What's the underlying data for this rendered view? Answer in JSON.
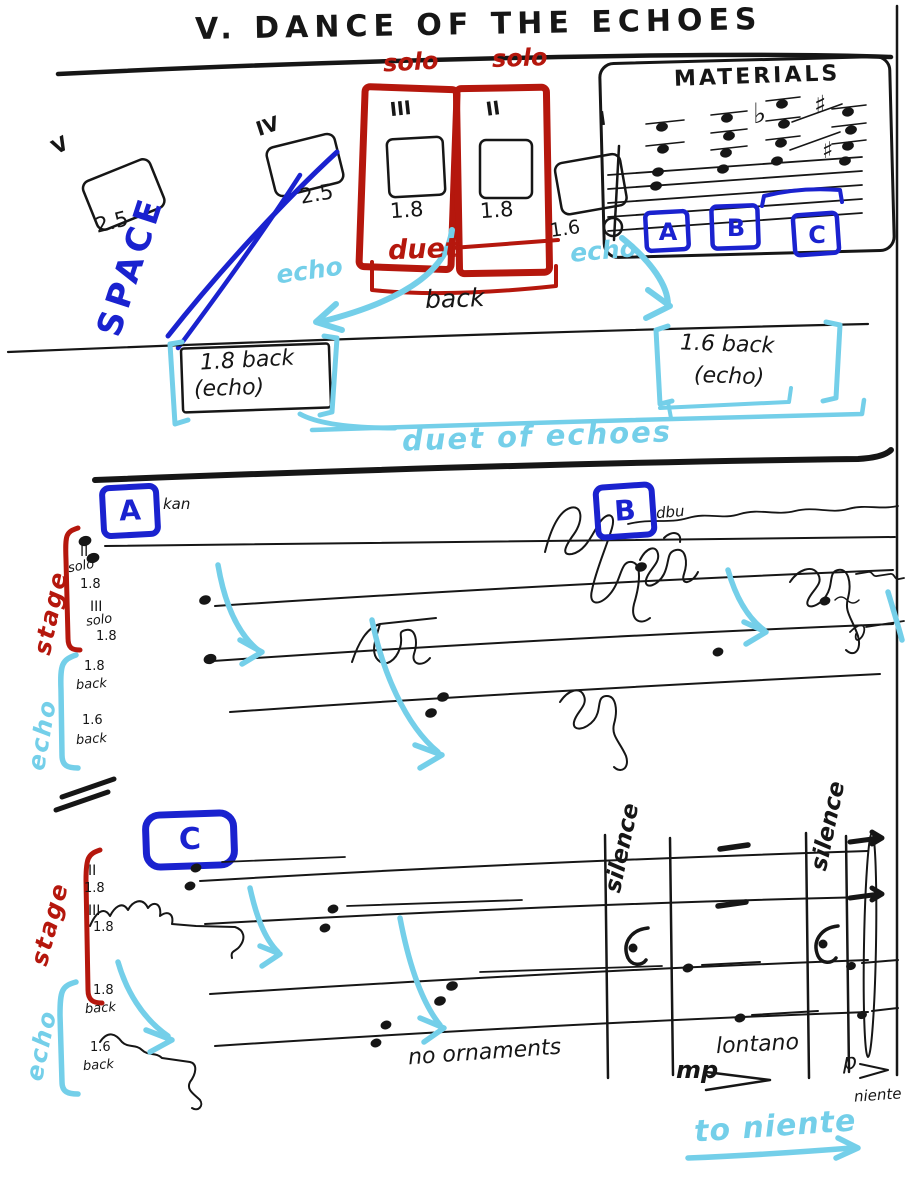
{
  "colors": {
    "ink": "#161616",
    "red": "#b5170d",
    "blue": "#1a22cf",
    "cyan": "#74cfe9"
  },
  "title": "V. DANCE OF THE ECHOES",
  "space": {
    "label": "SPACE"
  },
  "stations": {
    "solo_1": "solo",
    "solo_2": "solo",
    "duet": "duet",
    "items": [
      {
        "numeral": "V",
        "value": "2.5"
      },
      {
        "numeral": "IV",
        "value": "2.5"
      },
      {
        "numeral": "III",
        "value": "1.8"
      },
      {
        "numeral": "II",
        "value": "1.8"
      },
      {
        "numeral": "I",
        "value": "1.6"
      }
    ]
  },
  "materials": {
    "title": "MATERIALS",
    "labels": [
      "A",
      "B",
      "C"
    ],
    "accidentals": {
      "flat": "♭",
      "sharp_high": "♯",
      "sharp_low": "♯"
    }
  },
  "space_plan": {
    "echo_left": "echo",
    "echo_right": "echo",
    "back": "back",
    "box_left": {
      "line1": "1.8 back",
      "line2": "(echo)"
    },
    "box_right": {
      "line1": "1.6 back",
      "line2": "(echo)"
    },
    "duet_of_echoes": "duet of echoes"
  },
  "score1": {
    "marker_a": "A",
    "note_a": "kan",
    "marker_b": "B",
    "note_b": "dbu",
    "stage": "stage",
    "echo": "echo",
    "rows": [
      [
        "II",
        "solo",
        "1.8"
      ],
      [
        "III",
        "solo",
        "1.8"
      ],
      [
        "1.8",
        "back"
      ],
      [
        "1.6",
        "back"
      ]
    ]
  },
  "score2": {
    "marker_c": "C",
    "stage": "stage",
    "echo": "echo",
    "rows": [
      [
        "II",
        "1.8"
      ],
      [
        "III",
        "1.8"
      ],
      [
        "1.8",
        "back"
      ],
      [
        "1.6",
        "back"
      ]
    ],
    "silences": [
      "silence",
      "silence"
    ],
    "no_ornaments": "no ornaments",
    "lontano": "lontano",
    "dyn_mp": "mp",
    "dyn_p": "p",
    "niente": "niente",
    "to_niente": "to niente"
  }
}
